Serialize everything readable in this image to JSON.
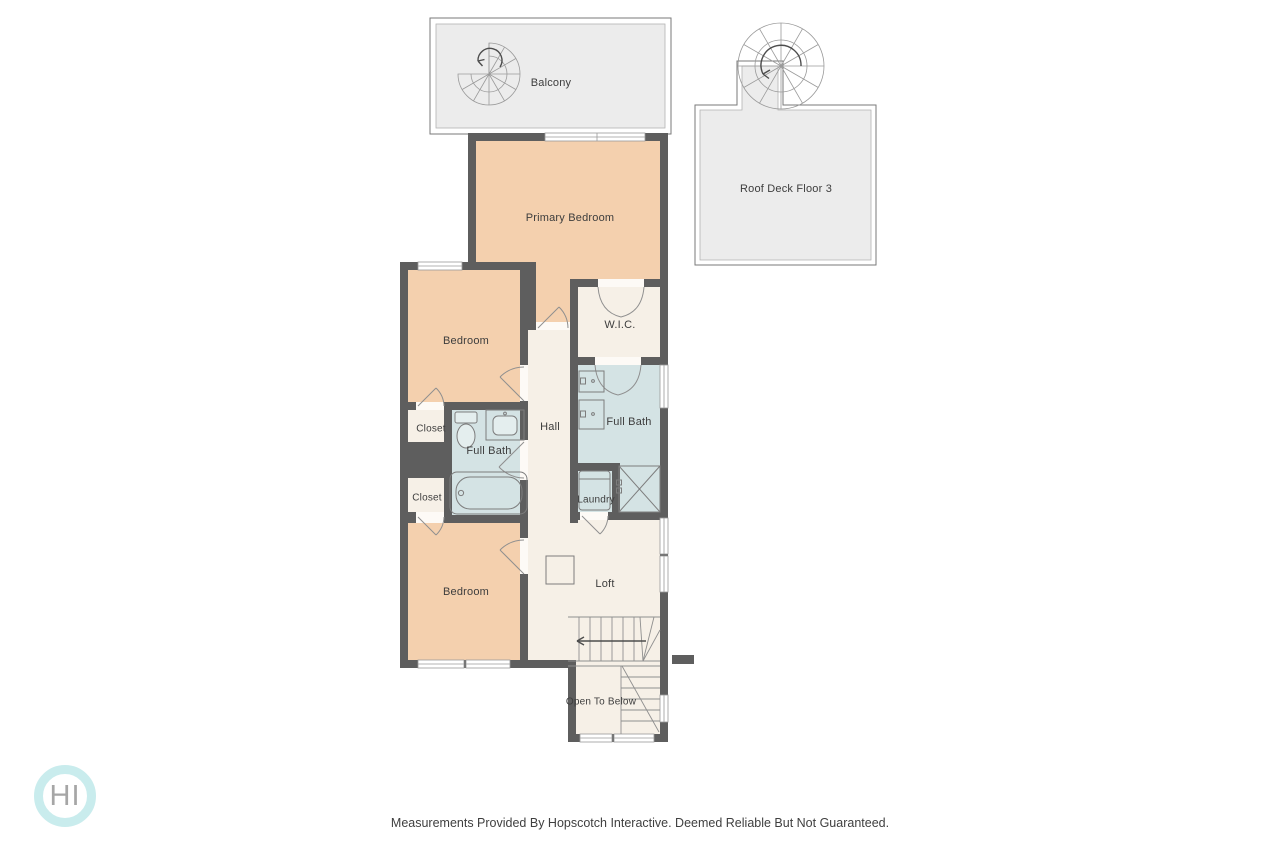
{
  "floorplan": {
    "rooms": {
      "balcony": {
        "label": "Balcony"
      },
      "roof_deck": {
        "label": "Roof Deck Floor 3"
      },
      "primary_bedroom": {
        "label": "Primary Bedroom"
      },
      "bedroom_upper": {
        "label": "Bedroom"
      },
      "wic": {
        "label": "W.I.C."
      },
      "full_bath_right": {
        "label": "Full Bath"
      },
      "hall": {
        "label": "Hall"
      },
      "closet_upper": {
        "label": "Closet"
      },
      "full_bath_left": {
        "label": "Full Bath"
      },
      "closet_lower": {
        "label": "Closet"
      },
      "laundry": {
        "label": "Laundry"
      },
      "bedroom_lower": {
        "label": "Bedroom"
      },
      "loft": {
        "label": "Loft"
      },
      "open_to_below": {
        "label": "Open To Below"
      }
    },
    "colors": {
      "wall": "#5e5e5e",
      "bedroom_fill": "#f4d0ae",
      "bath_fill": "#d4e3e4",
      "neutral_fill": "#f6f0e7",
      "deck_fill": "#ececec",
      "logo_ring": "#c9eced",
      "label_text": "#3d3d3d"
    }
  },
  "logo": {
    "text": "HI"
  },
  "footer": {
    "disclaimer": "Measurements Provided By Hopscotch Interactive. Deemed Reliable But Not Guaranteed."
  }
}
